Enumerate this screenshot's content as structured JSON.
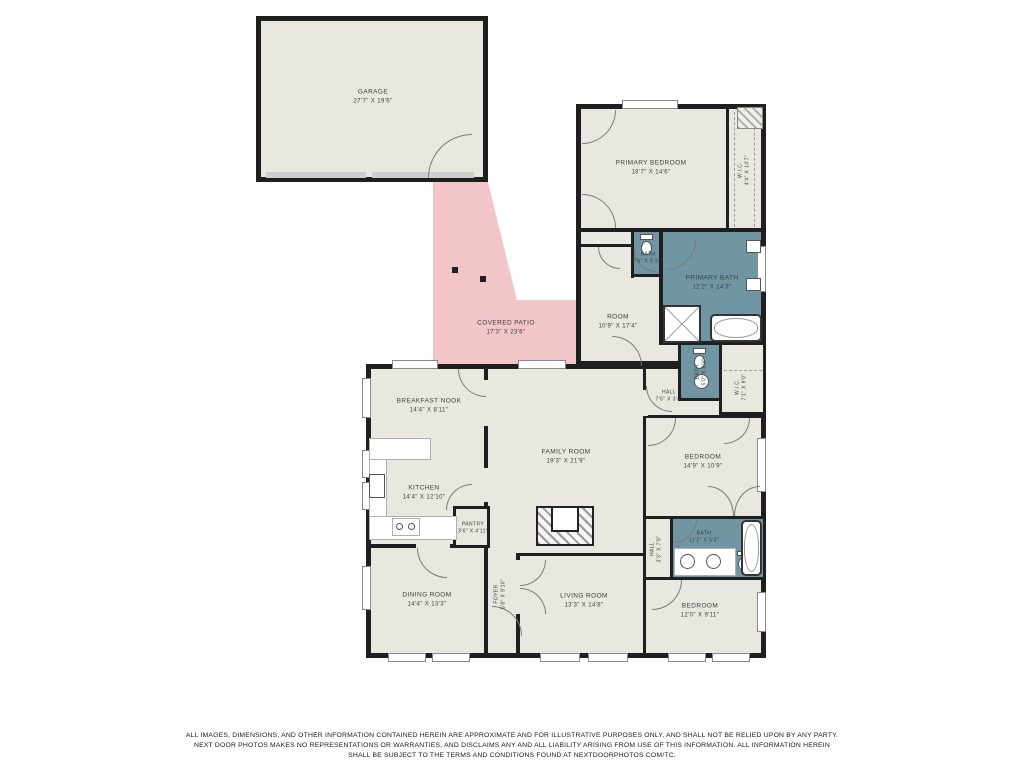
{
  "colors": {
    "wall": "#1f1f1f",
    "room_fill": "#e9e8e0",
    "patio_fill": "#f2c6c9",
    "bath_fill": "#7095a3",
    "label_text": "#3c3c3c"
  },
  "rooms": [
    {
      "id": "garage",
      "name": "GARAGE",
      "dims": "27'7\" X 19'6\""
    },
    {
      "id": "primary-bedroom",
      "name": "PRIMARY BEDROOM",
      "dims": "18'7\" X 14'6\""
    },
    {
      "id": "wic-primary",
      "name": "W.I.C.",
      "dims": "4'4\" X 14'7\""
    },
    {
      "id": "bath-wc-primary",
      "name": "BATH",
      "dims": "2'6\" X 5'10\""
    },
    {
      "id": "primary-bath",
      "name": "PRIMARY BATH",
      "dims": "12'2\" X 14'3\""
    },
    {
      "id": "room",
      "name": "ROOM",
      "dims": "10'9\" X 17'4\""
    },
    {
      "id": "covered-patio",
      "name": "COVERED PATIO",
      "dims": "17'3\" X 23'6\""
    },
    {
      "id": "bath-wc-hall",
      "name": "BATH",
      "dims": "5'0\" X 5'3\""
    },
    {
      "id": "wic-2",
      "name": "W.I.C.",
      "dims": "7'1\" X 9'0\""
    },
    {
      "id": "hall-1",
      "name": "HALL",
      "dims": "7'6\" X 3'4\""
    },
    {
      "id": "breakfast-nook",
      "name": "BREAKFAST NOOK",
      "dims": "14'4\" X 8'11\""
    },
    {
      "id": "kitchen",
      "name": "KITCHEN",
      "dims": "14'4\" X 12'10\""
    },
    {
      "id": "pantry",
      "name": "PANTRY",
      "dims": "3'6\" X 4'11\""
    },
    {
      "id": "family-room",
      "name": "FAMILY ROOM",
      "dims": "19'3\" X 21'9\""
    },
    {
      "id": "bedroom-2",
      "name": "BEDROOM",
      "dims": "14'9\" X 10'9\""
    },
    {
      "id": "hall-2",
      "name": "HALL",
      "dims": "3'3\" X 7'8\""
    },
    {
      "id": "bath-2",
      "name": "BATH",
      "dims": "11'2\" X 5'3\""
    },
    {
      "id": "dining-room",
      "name": "DINING ROOM",
      "dims": "14'4\" X 13'3\""
    },
    {
      "id": "foyer",
      "name": "FOYER",
      "dims": "5'8\" X 9'10\""
    },
    {
      "id": "living-room",
      "name": "LIVING ROOM",
      "dims": "13'3\" X 14'8\""
    },
    {
      "id": "bedroom-3",
      "name": "BEDROOM",
      "dims": "12'0\" X 9'11\""
    }
  ],
  "icons": {
    "door-icon": "quarter-arc",
    "window-icon": "white-gap-in-wall",
    "toilet-icon": "tank-plus-oval-bowl",
    "sink-icon": "circle-basin",
    "bathtub-icon": "rounded-rect-with-oval",
    "shower-icon": "square-with-x",
    "fireplace-icon": "hatched-box",
    "closet-rod-icon": "dashed-line",
    "stove-icon": "two-burner-circles",
    "garage-door-icon": "gray-strip",
    "patio-post-icon": "small-black-square"
  },
  "disclaimer": {
    "line1": "ALL IMAGES, DIMENSIONS, AND OTHER INFORMATION CONTAINED HEREIN ARE APPROXIMATE AND FOR ILLUSTRATIVE PURPOSES ONLY, AND SHALL NOT BE RELIED UPON BY ANY PARTY.",
    "line2": "NEXT DOOR PHOTOS MAKES NO REPRESENTATIONS OR WARRANTIES, AND DISCLAIMS ANY AND ALL LIABILITY ARISING FROM USE OF THIS INFORMATION. ALL INFORMATION HEREIN",
    "line3": "SHALL BE SUBJECT TO THE TERMS AND CONDITIONS FOUND AT NEXTDOORPHOTOS.COM/TC."
  }
}
